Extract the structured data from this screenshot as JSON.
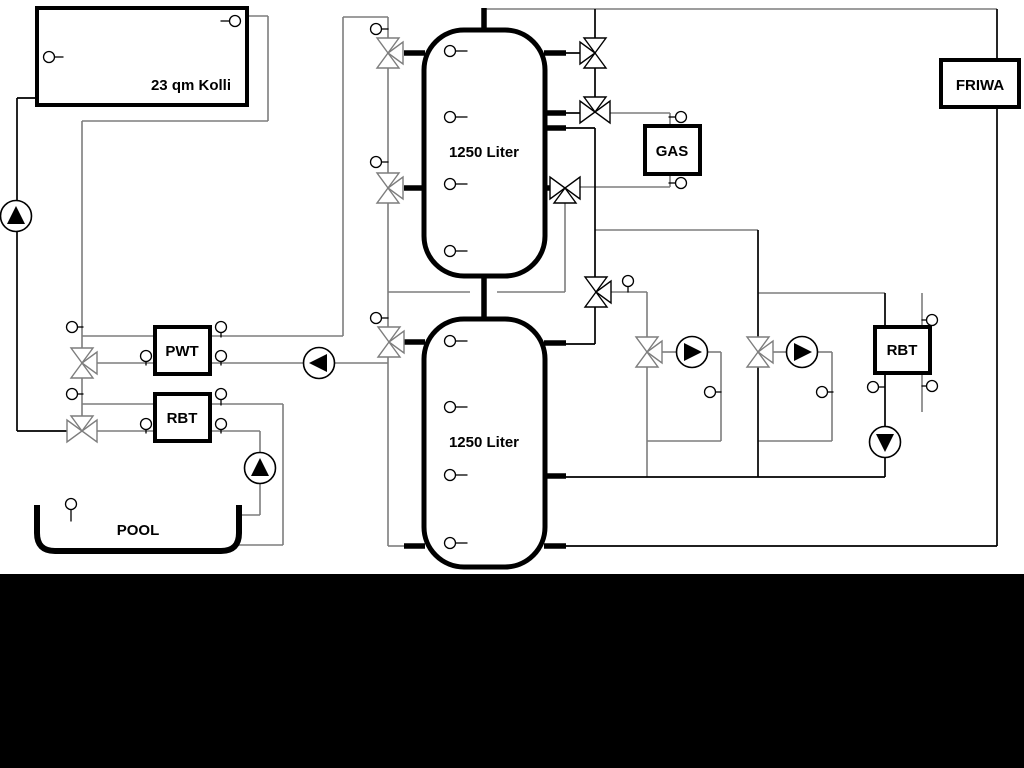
{
  "diagram": {
    "title": "Heating / solar hydraulic schematic",
    "labels": {
      "collector": "23 qm Kolli",
      "tank_top": "1250 Liter",
      "tank_bottom": "1250 Liter",
      "pwt": "PWT",
      "rbt_left": "RBT",
      "gas": "GAS",
      "friwa": "FRIWA",
      "rbt_right": "RBT",
      "pool": "POOL"
    },
    "components": {
      "tanks": [
        {
          "label": "1250 Liter"
        },
        {
          "label": "1250 Liter"
        }
      ],
      "pumps": [
        {
          "id": "solar-pump",
          "direction": "up"
        },
        {
          "id": "pool-pump",
          "direction": "up"
        },
        {
          "id": "charge-pump",
          "direction": "left"
        },
        {
          "id": "heating-circuit-1-pump",
          "direction": "right"
        },
        {
          "id": "heating-circuit-2-pump",
          "direction": "right"
        },
        {
          "id": "rbt-return-pump",
          "direction": "down"
        }
      ],
      "three_way_valve_count": 11,
      "sensor_count": 30
    },
    "colors": {
      "line_gray": "#7d7d7d",
      "line_black": "#000000",
      "component_fill": "#ffffff",
      "background": "#ffffff",
      "bottom_bar": "#000000"
    }
  }
}
